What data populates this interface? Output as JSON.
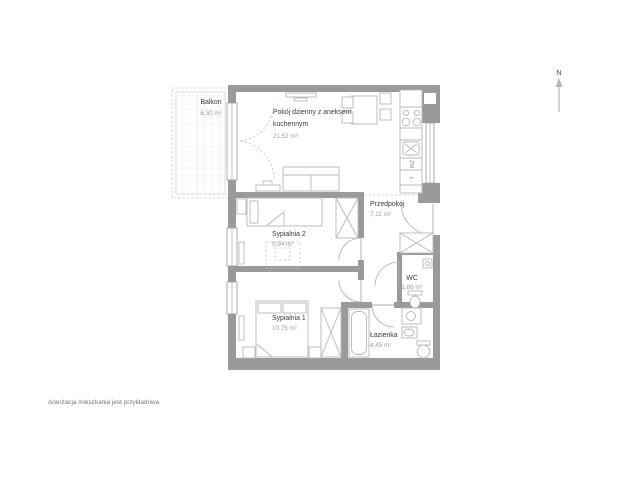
{
  "floor_plan": {
    "rooms": {
      "balkon": {
        "name": "Balkon",
        "area": "6,30 m²"
      },
      "pokoj_dzienny": {
        "name_line1": "Pokój dzienny z aneksem",
        "name_line2": "kuchennym",
        "area": "21,52 m²"
      },
      "przedpokoj": {
        "name": "Przedpokój",
        "area": "7,11 m²"
      },
      "sypialnia2": {
        "name": "Sypialnia 2",
        "area": "9,94 m²"
      },
      "sypialnia1": {
        "name": "Sypialnia 1",
        "area": "10,75 m²"
      },
      "wc": {
        "name": "WC",
        "area": "1,86 m²"
      },
      "lazienka": {
        "name": "Łazienka",
        "area": "4,45 m²"
      }
    },
    "kitchen_labels": {
      "dishwasher": "ZM",
      "fridge": "L"
    },
    "compass_label": "N",
    "footnote": "Aranżacja mieszkania jest przykładowa",
    "colors": {
      "wall": "#9a9a9a",
      "furniture_line": "#b8b8b8",
      "room_name_text": "#3c3c3c",
      "area_text": "#9e9e9e"
    }
  }
}
